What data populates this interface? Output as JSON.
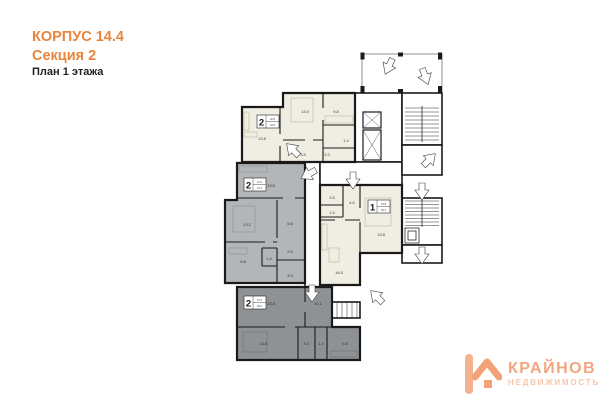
{
  "title": {
    "building": "КОРПУС 14.4",
    "section": "Секция 2",
    "floor": "План 1 этажа"
  },
  "logo": {
    "brand": "КРАЙНОВ",
    "subtitle": "НЕДВИЖИМОСТЬ",
    "icon": "k-house-icon",
    "color": "#F2A57E"
  },
  "colors": {
    "accent_orange": "#E8843C",
    "wall_black": "#1A1A1A",
    "apartment_cream": "#F0EDE2",
    "apartment_gray": "#B3B6B9",
    "apartment_dark_gray": "#8F9295",
    "common_white": "#FFFFFF",
    "logo_peach": "#F2A57E"
  },
  "plan": {
    "kind": "floor-plan",
    "symbols": {
      "entry_arrow": "white-block-arrow",
      "elevator": "box-with-x",
      "stairs": "hatched-steps"
    },
    "badges": {
      "a1": {
        "type": "2",
        "c1": "26.8",
        "c2": "44.8"
      },
      "a2": {
        "type": "2",
        "c1": "27.0",
        "c2": "47.2"
      },
      "a3": {
        "type": "1",
        "c1": "13.8",
        "c2": "39.3"
      },
      "a4": {
        "type": "2",
        "c1": "27.6",
        "c2": "46.0"
      }
    },
    "labels": {
      "a1_living": "13.8",
      "a1_bedroom": "13.0",
      "a1_kitchen": "9.8",
      "a1_bath": "1.4",
      "a1_hall1": "3.5",
      "a1_hall2": "3.3",
      "a2_room1": "13.8",
      "a2_room2": "13.2",
      "a2_room3": "9.8",
      "a2_hall": "5.6",
      "a2_wc": "2.9",
      "a2_bath": "1.4",
      "a2_corr": "3.3",
      "a3_bath": "3.5",
      "a3_wc": "1.5",
      "a3_hall": "4.0",
      "a3_kitchen_living": "16.5",
      "a3_room": "13.8",
      "a4_room1": "13.8",
      "a4_hall": "10.1",
      "a4_room2": "13.8",
      "a4_bath": "3.3",
      "a4_wc": "1.4",
      "a4_kitchen": "9.8"
    }
  }
}
